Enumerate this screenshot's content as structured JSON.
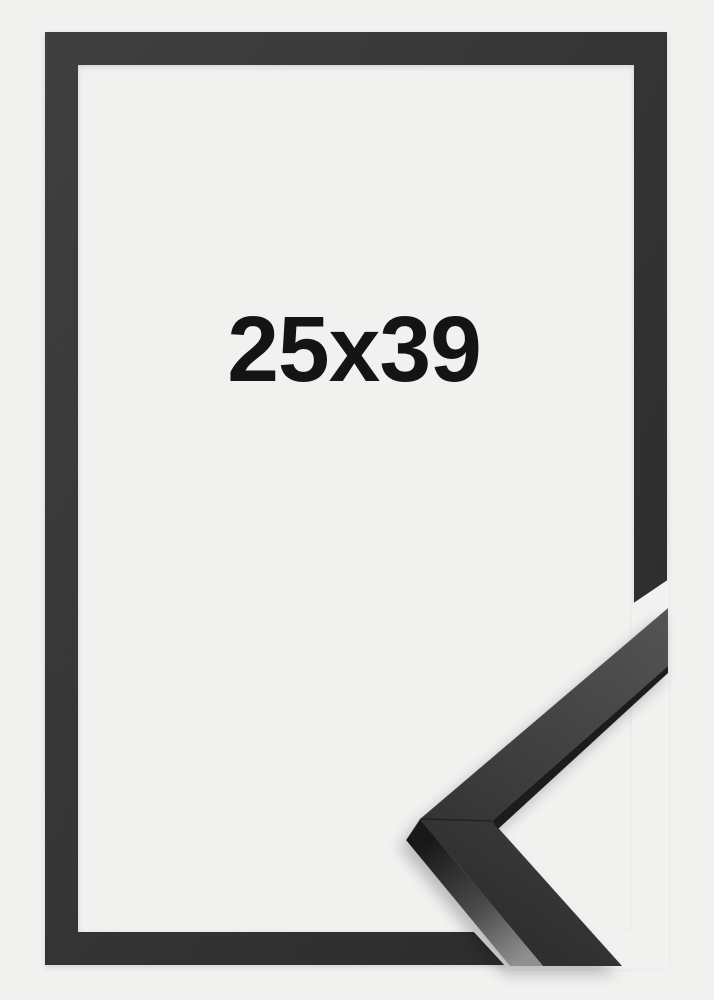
{
  "product_photo": {
    "size_label": "25x39",
    "frame_color": "#2f2f2f",
    "frame_color_dark": "#262626",
    "frame_color_light": "#3c3c3c",
    "background_color": "#f1f1f0",
    "label_color": "#141414"
  }
}
